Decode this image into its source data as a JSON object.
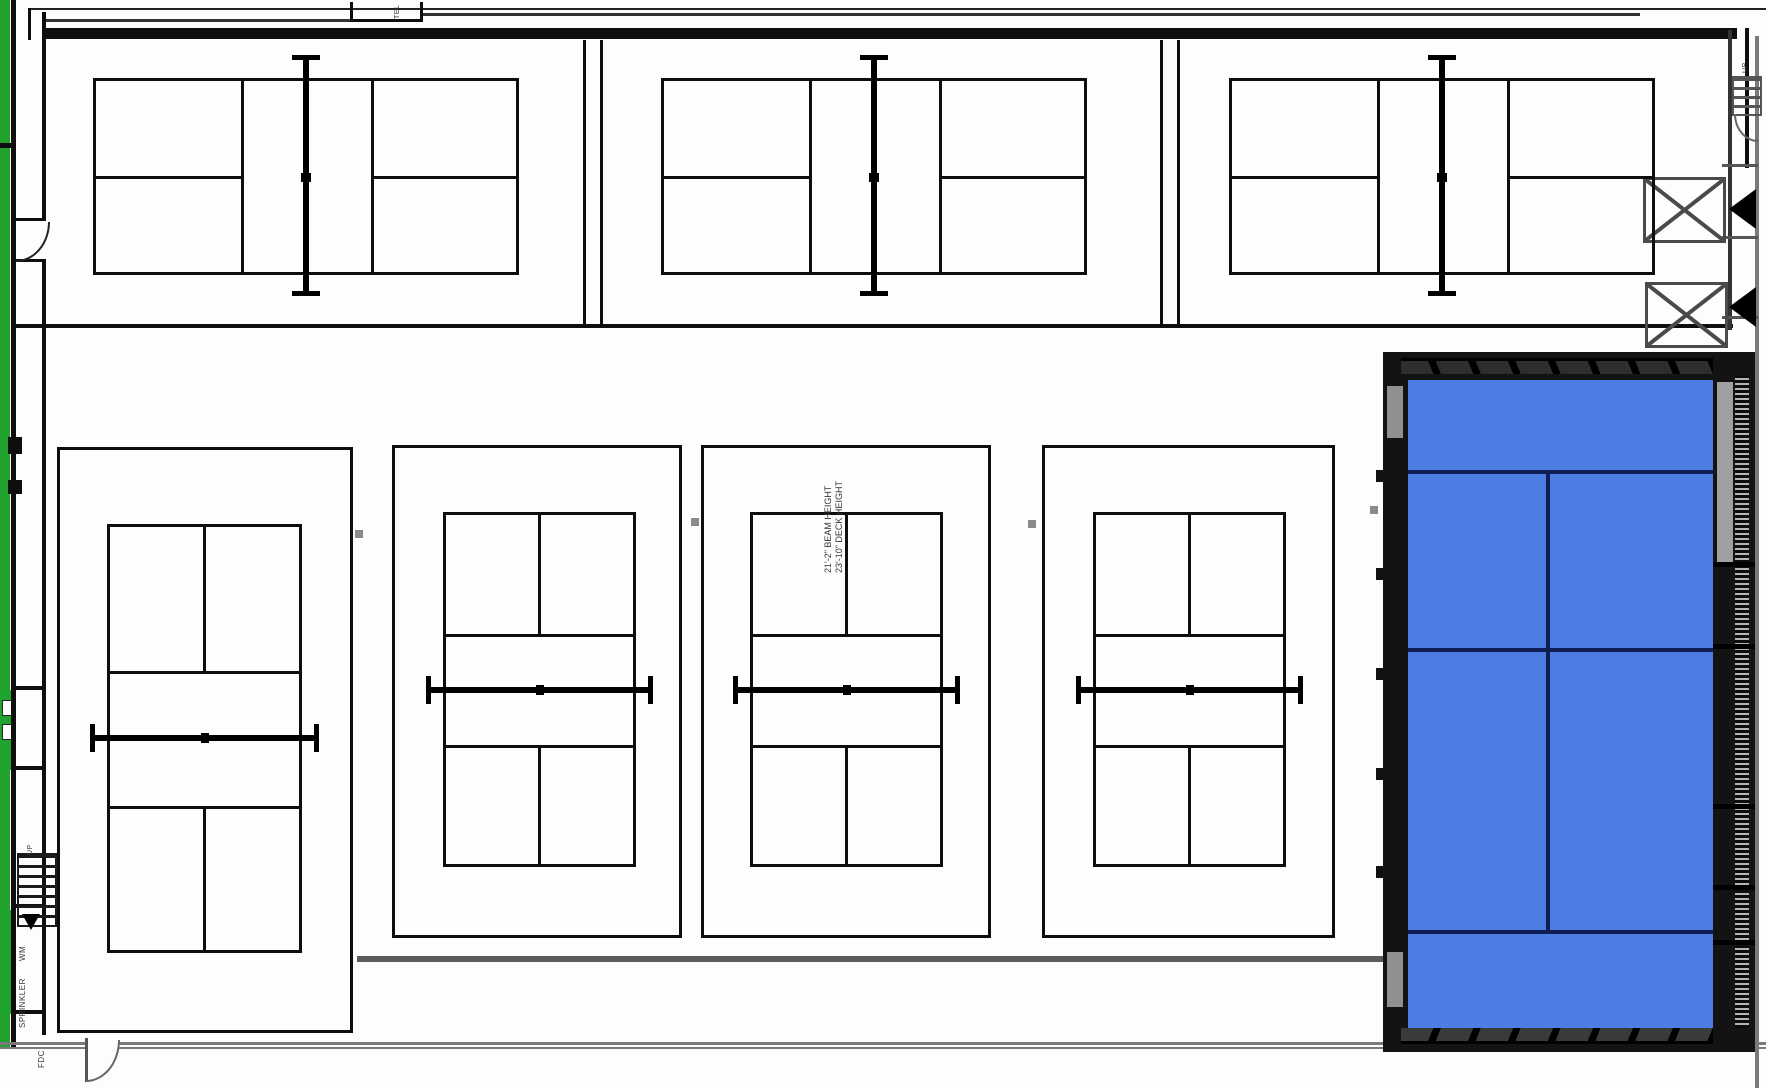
{
  "labels": {
    "tel": "TEL",
    "up_top_right": "UP",
    "up_left": "UP",
    "wm": "WM",
    "sprinkler": "SPRINKLER",
    "fdc": "FDC",
    "beam_height": "21'-2\" BEAM HEIGHT",
    "deck_height": "23'-10\" DECK HEIGHT"
  },
  "colors": {
    "line_black": "#0e0e0e",
    "net_black": "#000000",
    "wall_gray": "#7a7a7a",
    "accent_green": "#1fa32c",
    "court_blue": "#4d7de2",
    "court_line_navy": "#0f1f56",
    "frame_black": "#131313",
    "panel_gray": "#909090",
    "marker_gray": "#8a8a8a"
  },
  "courts": {
    "top_row": [
      {
        "id": "court-top-1",
        "x": 93,
        "y": 78,
        "w": 426,
        "h": 197,
        "net_x": 306,
        "k1": 241,
        "k2": 371,
        "svc_y": 176
      },
      {
        "id": "court-top-2",
        "x": 661,
        "y": 78,
        "w": 426,
        "h": 197,
        "net_x": 874,
        "k1": 809,
        "k2": 939,
        "svc_y": 176
      },
      {
        "id": "court-top-3",
        "x": 1229,
        "y": 78,
        "w": 426,
        "h": 197,
        "net_x": 1442,
        "k1": 1377,
        "k2": 1507,
        "svc_y": 176
      }
    ],
    "bottom_row": [
      {
        "id": "court-bottom-1",
        "enc": [
          57,
          447,
          296,
          586
        ],
        "play": [
          107,
          524,
          195,
          429
        ],
        "k1": 671,
        "k2": 806,
        "net": 738
      },
      {
        "id": "court-bottom-2",
        "enc": [
          392,
          445,
          290,
          493
        ],
        "play": [
          443,
          512,
          193,
          355
        ],
        "k1": 634,
        "k2": 745,
        "net": 690
      },
      {
        "id": "court-bottom-3",
        "enc": [
          701,
          445,
          290,
          493
        ],
        "play": [
          750,
          512,
          193,
          355
        ],
        "k1": 634,
        "k2": 745,
        "net": 690
      },
      {
        "id": "court-bottom-4",
        "enc": [
          1042,
          445,
          293,
          493
        ],
        "play": [
          1093,
          512,
          193,
          355
        ],
        "k1": 634,
        "k2": 745,
        "net": 690
      }
    ],
    "highlighted": {
      "id": "court-highlighted",
      "x": 1383,
      "y": 352,
      "w": 372,
      "h": 700,
      "surface": [
        25,
        28,
        305,
        648
      ],
      "h_lines": [
        118,
        296,
        578
      ],
      "center_x": 165,
      "center_span": [
        118,
        582
      ],
      "left_nub_ys": [
        470,
        568,
        668,
        768,
        866
      ]
    }
  },
  "markers": [
    [
      355,
      530
    ],
    [
      691,
      518
    ],
    [
      1028,
      520
    ],
    [
      1370,
      506
    ]
  ]
}
